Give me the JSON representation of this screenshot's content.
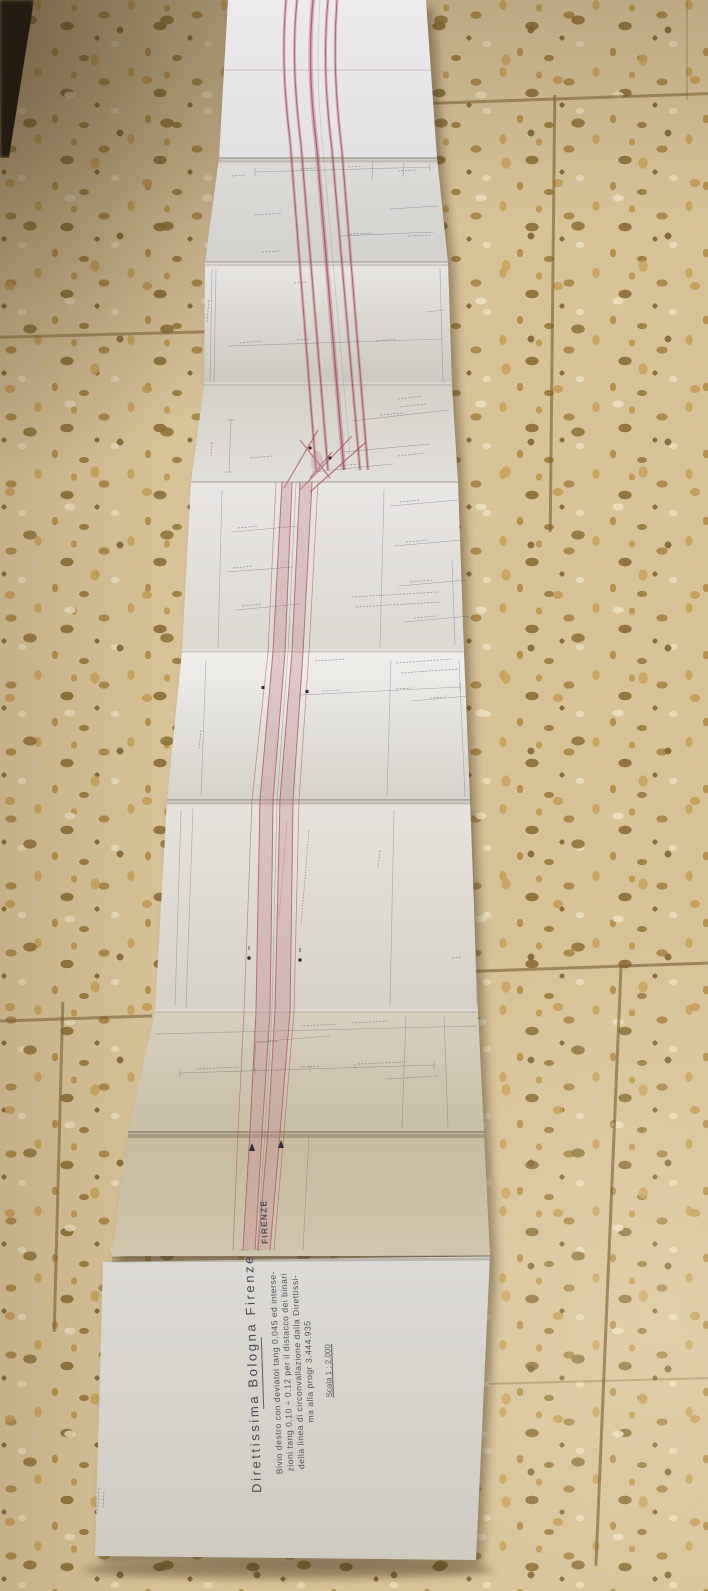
{
  "colors": {
    "track_red": "#a8485a",
    "track_red_fill": "#c98f9a",
    "ink": "#54545e",
    "paper_light": "#e6e4e0",
    "paper_khaki": "#c9bda2",
    "floor_base": "#d8c399",
    "grout": "#7a6034"
  },
  "title_block": {
    "title": "Direttissima Bologna Firenze",
    "line1": "Bivio destro con deviatoi tang 0.045 ed interse-",
    "line2": "zioni tang 0.10 ÷ 0.12 per il distacco dei binari",
    "line3": "della linea di circonvallazione dalla Direttissi-",
    "line4": "ma alla progr 3.444.935",
    "scale": "Scala 1 : 2.000"
  },
  "stamp": {
    "label": "FIRENZE"
  }
}
